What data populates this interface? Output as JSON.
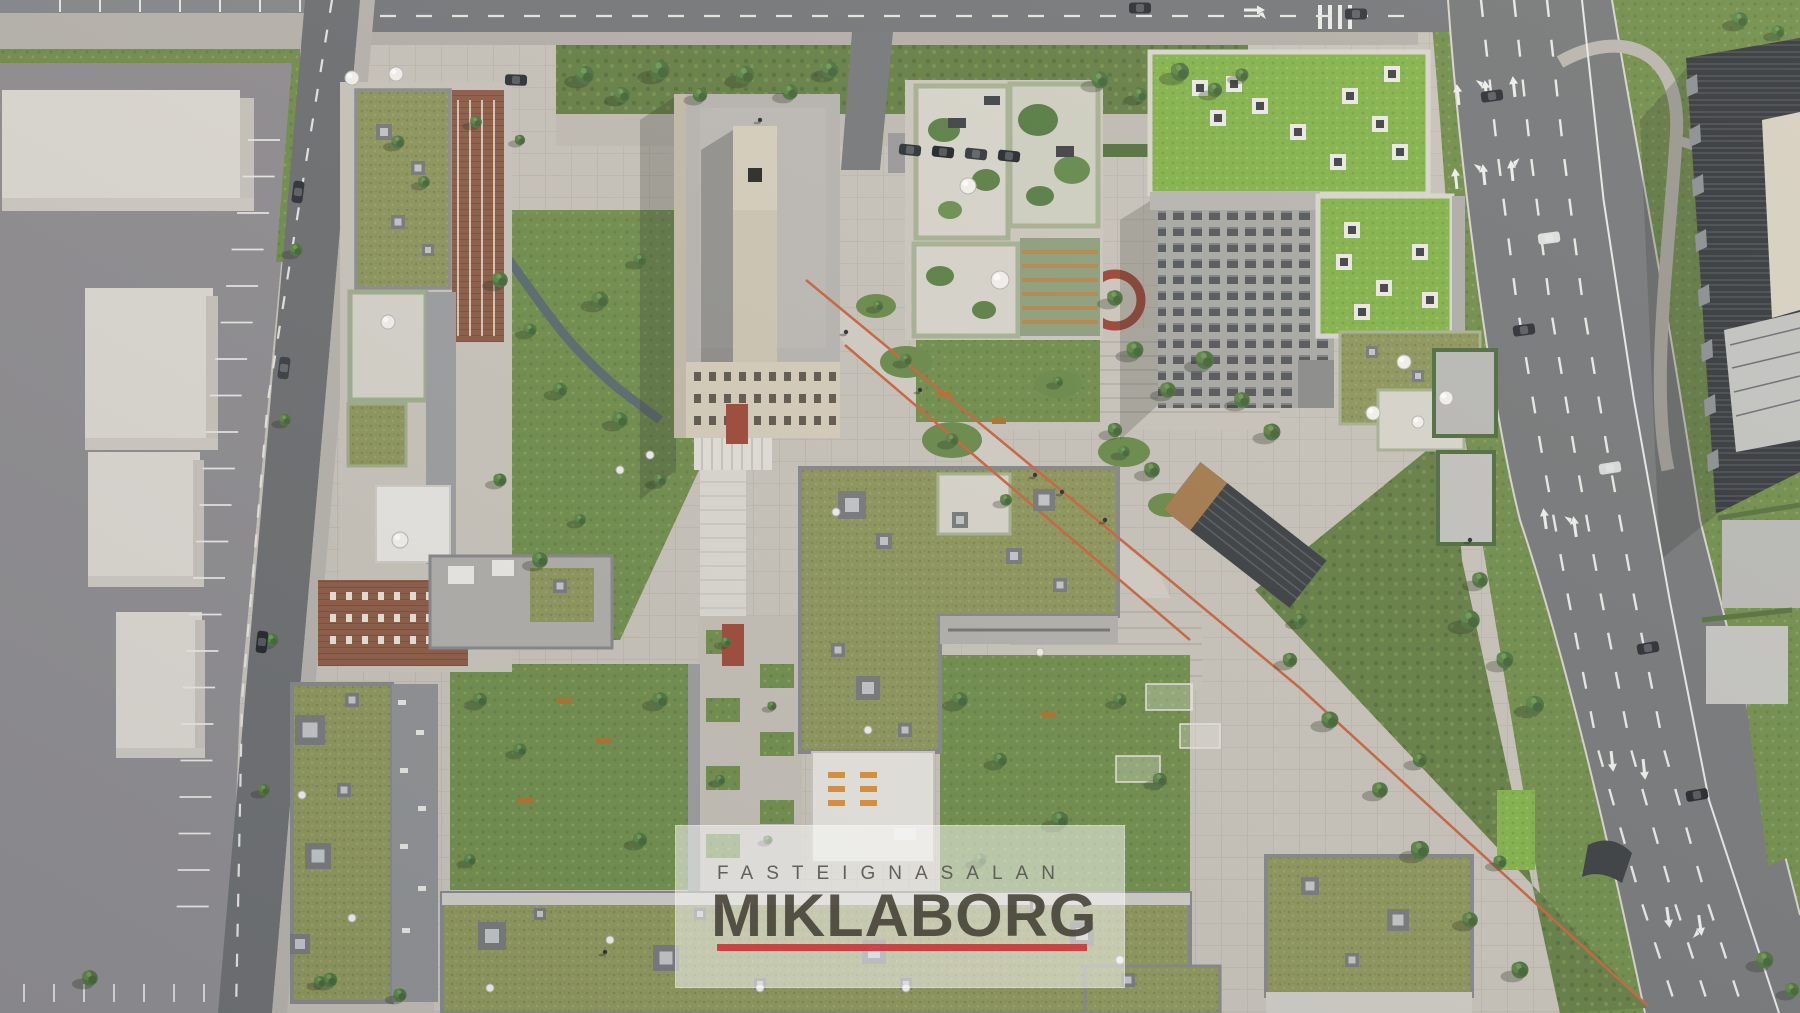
{
  "watermark": {
    "subtitle": "FASTEIGNASALAN",
    "title": "MIKLABORG",
    "accent_color": "#c9353a"
  },
  "scene": {
    "description": "Aerial rendering of a residential city block development with green roofs, courtyards, plazas and surrounding streets",
    "palette": {
      "paving": "#c8c3ba",
      "paving_light": "#d3cdc3",
      "parking": "#8f8d90",
      "asphalt": "#6d6f71",
      "road": "#76787a",
      "sidewalk": "#b7b3ac",
      "lawn": "#718e4c",
      "scrub": "#657f45",
      "olive_roof": "#8e965c",
      "bright_roof": "#84b34b",
      "sage": "#9fae8d",
      "brick": "#8d5c46",
      "beige_roof": "#b8b5b1",
      "beige_wall": "#d6cdba",
      "gray_tower": "#a8a8a5",
      "dark_building": "#33373a",
      "white_terrace": "#e6e4de",
      "red_line": "#c8643f",
      "marking": "#ececea"
    }
  }
}
